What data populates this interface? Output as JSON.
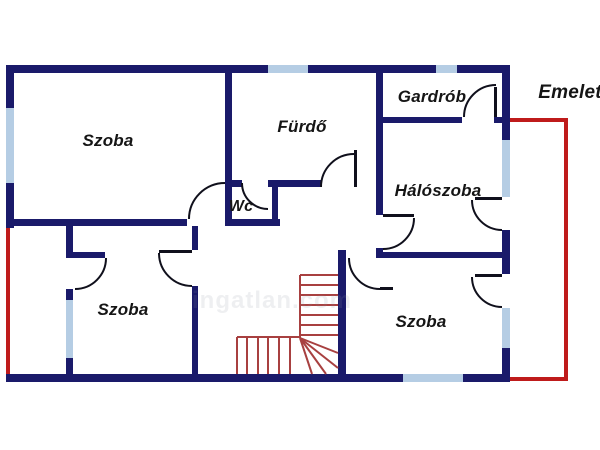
{
  "title": "Emelet",
  "colors": {
    "wall": "#1a1a6a",
    "window": "#b5cde4",
    "outline_red": "#bf1b1b",
    "stairs_red": "#a84040",
    "door_line": "#10101c",
    "background": "#ffffff",
    "text": "#151515"
  },
  "labels": [
    {
      "text": "Szoba",
      "x": 108,
      "y": 141,
      "size": 17
    },
    {
      "text": "Fürdő",
      "x": 302,
      "y": 127,
      "size": 17
    },
    {
      "text": "Gardrób",
      "x": 432,
      "y": 97,
      "size": 17
    },
    {
      "text": "Hálószoba",
      "x": 438,
      "y": 191,
      "size": 17
    },
    {
      "text": "Wc",
      "x": 241,
      "y": 207,
      "size": 16
    },
    {
      "text": "Szoba",
      "x": 123,
      "y": 310,
      "size": 17
    },
    {
      "text": "Szoba",
      "x": 421,
      "y": 322,
      "size": 17
    },
    {
      "text": "Emelet",
      "x": 570,
      "y": 93,
      "size": 19
    }
  ],
  "watermark": {
    "text": "ingatlan.com",
    "x": 272,
    "y": 301
  },
  "plan": {
    "walls": [
      [
        6,
        65,
        504,
        8
      ],
      [
        6,
        65,
        8,
        43
      ],
      [
        6,
        183,
        8,
        45
      ],
      [
        6,
        374,
        504,
        8
      ],
      [
        502,
        65,
        8,
        75
      ],
      [
        502,
        230,
        8,
        44
      ],
      [
        502,
        348,
        8,
        34
      ],
      [
        6,
        219,
        181,
        7
      ],
      [
        225,
        73,
        7,
        146
      ],
      [
        225,
        219,
        55,
        7
      ],
      [
        272,
        182,
        6,
        37
      ],
      [
        232,
        180,
        10,
        7
      ],
      [
        268,
        180,
        54,
        7
      ],
      [
        376,
        65,
        7,
        150
      ],
      [
        376,
        248,
        7,
        10
      ],
      [
        383,
        117,
        79,
        6
      ],
      [
        494,
        117,
        8,
        6
      ],
      [
        380,
        252,
        122,
        6
      ],
      [
        338,
        250,
        8,
        124
      ],
      [
        66,
        226,
        7,
        32
      ],
      [
        73,
        252,
        32,
        6
      ],
      [
        66,
        289,
        7,
        11
      ],
      [
        66,
        358,
        7,
        16
      ],
      [
        192,
        226,
        6,
        24
      ],
      [
        192,
        286,
        6,
        88
      ]
    ],
    "windows": [
      [
        6,
        108,
        8,
        75
      ],
      [
        268,
        65,
        40,
        8
      ],
      [
        436,
        65,
        21,
        8
      ],
      [
        502,
        140,
        8,
        57
      ],
      [
        502,
        308,
        8,
        40
      ],
      [
        403,
        374,
        60,
        8
      ],
      [
        66,
        300,
        7,
        58
      ]
    ],
    "red_outline": [
      [
        6,
        228,
        4,
        146
      ],
      [
        510,
        118,
        58,
        4
      ],
      [
        564,
        118,
        4,
        263
      ],
      [
        510,
        377,
        54,
        4
      ]
    ],
    "door_leaves": [
      [
        354,
        150,
        3,
        37
      ],
      [
        494,
        87,
        3,
        30
      ],
      [
        383,
        214,
        31,
        3
      ],
      [
        475,
        197,
        27,
        3
      ],
      [
        475,
        274,
        27,
        3
      ],
      [
        159,
        250,
        33,
        3
      ],
      [
        380,
        287,
        13,
        3
      ]
    ],
    "door_arcs": [
      "M189,219 A36,36 0 0 1 225,183",
      "M242,183 A26,26 0 0 0 268,209",
      "M321,187 A33,33 0 0 1 354,154",
      "M414,218 A31,31 0 0 1 383,249",
      "M464,117 A32,32 0 0 1 496,85",
      "M472,200 A30,30 0 0 0 502,230",
      "M472,277 A30,30 0 0 0 502,307",
      "M349,258 A31,31 0 0 0 380,289",
      "M106,258 A31,31 0 0 1 75,289",
      "M159,253 A33,33 0 0 0 192,286"
    ],
    "stair_lines": [
      [
        300,
        275,
        300,
        338
      ],
      [
        300,
        275,
        338,
        275
      ],
      [
        300,
        285,
        338,
        285
      ],
      [
        300,
        295,
        338,
        295
      ],
      [
        300,
        305,
        338,
        305
      ],
      [
        300,
        315,
        338,
        315
      ],
      [
        300,
        325,
        338,
        325
      ],
      [
        300,
        335,
        338,
        335
      ],
      [
        237,
        337,
        300,
        337
      ],
      [
        237,
        337,
        237,
        374
      ],
      [
        247,
        337,
        247,
        374
      ],
      [
        258,
        337,
        258,
        374
      ],
      [
        268,
        337,
        268,
        374
      ],
      [
        279,
        337,
        279,
        374
      ],
      [
        290,
        337,
        290,
        374
      ],
      [
        300,
        338,
        312,
        374
      ],
      [
        300,
        338,
        326,
        374
      ],
      [
        300,
        338,
        338,
        368
      ],
      [
        300,
        338,
        338,
        353
      ]
    ]
  }
}
